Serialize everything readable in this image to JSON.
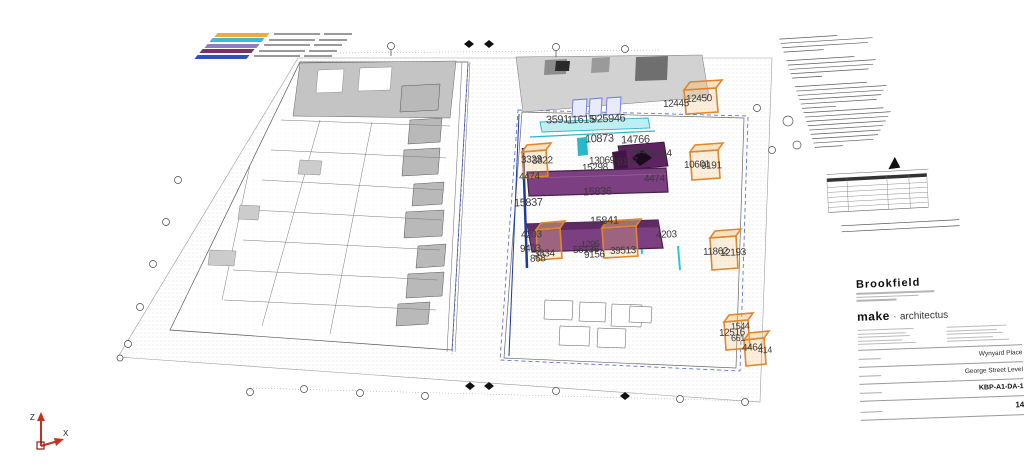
{
  "colors": {
    "background": "#ffffff",
    "plan_line": "#6f6f6f",
    "building_gray": "#c4c4c4",
    "slab_gray": "#d2d2d2",
    "purple_element": "#7c3f82",
    "purple_border": "#471f4b",
    "orange_selection": "#e0862c",
    "cyan_element": "#2fb5c9",
    "navy_line": "#1d3a9b",
    "dashed_blue": "#4f63d2",
    "axis_red": "#c5301f",
    "callout_text": "#3a3a3a"
  },
  "legend": {
    "colors": [
      "#f0a93c",
      "#3fb9d3",
      "#8a7fc3",
      "#7c2f66",
      "#2a52b8"
    ]
  },
  "plan": {
    "callouts": [
      {
        "text": "12450",
        "x": 686,
        "y": 99,
        "size": 10
      },
      {
        "text": "12445",
        "x": 663,
        "y": 104,
        "size": 10
      },
      {
        "text": "3591",
        "x": 546,
        "y": 120,
        "size": 11
      },
      {
        "text": "11615",
        "x": 567,
        "y": 120,
        "size": 11
      },
      {
        "text": "925946",
        "x": 591,
        "y": 119,
        "size": 11
      },
      {
        "text": "10873",
        "x": 585,
        "y": 139,
        "size": 11
      },
      {
        "text": "14766",
        "x": 621,
        "y": 140,
        "size": 11
      },
      {
        "text": "3441",
        "x": 630,
        "y": 152,
        "size": 10
      },
      {
        "text": "4414",
        "x": 651,
        "y": 154,
        "size": 10
      },
      {
        "text": "3323",
        "x": 521,
        "y": 160,
        "size": 10
      },
      {
        "text": "3822",
        "x": 532,
        "y": 161,
        "size": 10
      },
      {
        "text": "13069",
        "x": 589,
        "y": 161,
        "size": 10
      },
      {
        "text": "9167",
        "x": 617,
        "y": 162,
        "size": 10
      },
      {
        "text": "15298",
        "x": 582,
        "y": 168,
        "size": 10
      },
      {
        "text": "4474",
        "x": 519,
        "y": 177,
        "size": 10
      },
      {
        "text": "4474",
        "x": 644,
        "y": 179,
        "size": 10
      },
      {
        "text": "15836",
        "x": 583,
        "y": 192,
        "size": 11
      },
      {
        "text": "15837",
        "x": 514,
        "y": 203,
        "size": 11
      },
      {
        "text": "15841",
        "x": 590,
        "y": 221,
        "size": 11
      },
      {
        "text": "4203",
        "x": 521,
        "y": 235,
        "size": 10
      },
      {
        "text": "4203",
        "x": 656,
        "y": 235,
        "size": 10
      },
      {
        "text": "9403",
        "x": 520,
        "y": 249,
        "size": 10
      },
      {
        "text": "3834",
        "x": 534,
        "y": 254,
        "size": 10
      },
      {
        "text": "868",
        "x": 530,
        "y": 259,
        "size": 10
      },
      {
        "text": "1295",
        "x": 581,
        "y": 244,
        "size": 9
      },
      {
        "text": "55136",
        "x": 573,
        "y": 250,
        "size": 10
      },
      {
        "text": "9156",
        "x": 584,
        "y": 255,
        "size": 10
      },
      {
        "text": "39513",
        "x": 610,
        "y": 251,
        "size": 10
      },
      {
        "text": "10601",
        "x": 684,
        "y": 165,
        "size": 10
      },
      {
        "text": "9191",
        "x": 701,
        "y": 166,
        "size": 10
      },
      {
        "text": "11862",
        "x": 703,
        "y": 252,
        "size": 10
      },
      {
        "text": "12193",
        "x": 720,
        "y": 253,
        "size": 10
      },
      {
        "text": "1544",
        "x": 731,
        "y": 326,
        "size": 9
      },
      {
        "text": "12516",
        "x": 719,
        "y": 333,
        "size": 10
      },
      {
        "text": "661",
        "x": 731,
        "y": 338,
        "size": 9
      },
      {
        "text": "4464",
        "x": 742,
        "y": 348,
        "size": 10
      },
      {
        "text": "414",
        "x": 758,
        "y": 350,
        "size": 9
      }
    ]
  },
  "titleblock": {
    "client": "Brookfield",
    "firm_primary": "make",
    "firm_separator": "·",
    "firm_secondary": "architectus",
    "project_name": "Wynyard Place",
    "sheet_title": "George Street Level",
    "drawing_number": "KBP-A1-DA-1",
    "sheet_note": "14"
  },
  "axes": {
    "z_label": "Z",
    "x_label": "X"
  }
}
